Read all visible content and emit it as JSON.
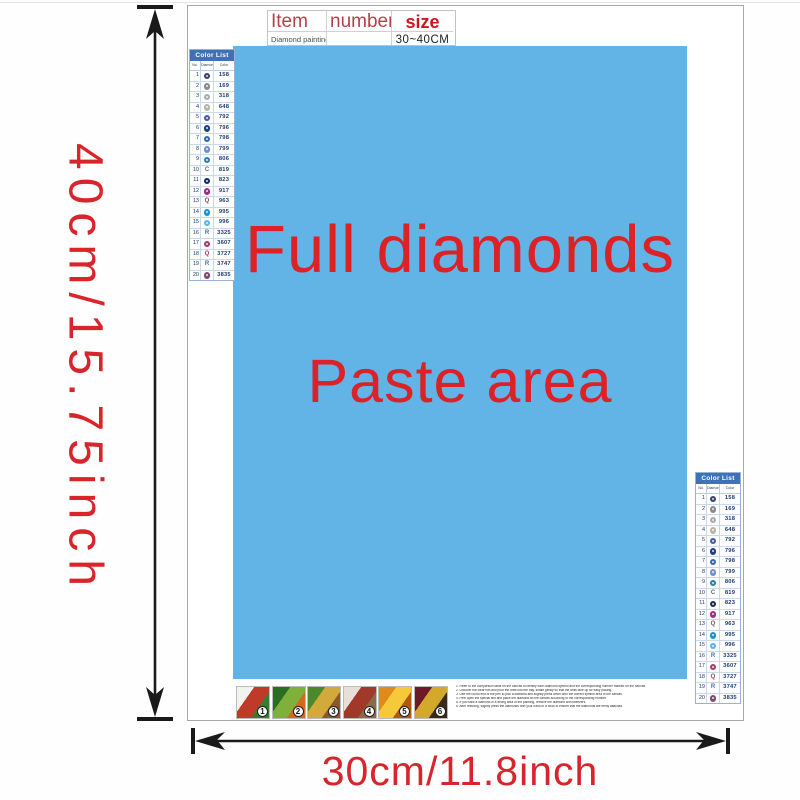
{
  "dimensions": {
    "height_label": "40cm/15.75inch",
    "width_label": "30cm/11.8inch",
    "arrow_color": "#1a1a1a",
    "label_color": "#d8242b"
  },
  "item_table": {
    "headers": [
      "Item",
      "number",
      "size"
    ],
    "row": {
      "item": "Diamond painting",
      "number": "",
      "size": "30~40CM"
    }
  },
  "canvas": {
    "bg": "#62b4e6",
    "line1": "Full diamonds",
    "line2": "Paste area",
    "text_color": "#dc2127"
  },
  "color_list": {
    "title": "Color List",
    "columns": [
      "No.",
      "Diamond",
      "Color"
    ],
    "header_bg": "#3e72b8",
    "rows": [
      {
        "no": "1",
        "type": "circle",
        "color": "#3a4272",
        "code": "158"
      },
      {
        "no": "2",
        "type": "circle",
        "color": "#8a8a90",
        "code": "169"
      },
      {
        "no": "3",
        "type": "circle",
        "color": "#a9a9ad",
        "code": "318"
      },
      {
        "no": "4",
        "type": "circle",
        "color": "#b9b4a8",
        "code": "648"
      },
      {
        "no": "5",
        "type": "circle",
        "color": "#4a5ba5",
        "code": "792"
      },
      {
        "no": "6",
        "type": "circle",
        "color": "#203d8e",
        "code": "796"
      },
      {
        "no": "7",
        "type": "circle",
        "color": "#3566b2",
        "code": "798"
      },
      {
        "no": "8",
        "type": "circle",
        "color": "#7090c8",
        "code": "799"
      },
      {
        "no": "9",
        "type": "circle",
        "color": "#2d7fb0",
        "code": "806"
      },
      {
        "no": "10",
        "type": "letter",
        "letter": "C",
        "color": "#5a6470",
        "code": "819"
      },
      {
        "no": "11",
        "type": "circle",
        "color": "#1c2b5e",
        "code": "823"
      },
      {
        "no": "12",
        "type": "circle",
        "color": "#9c2d8c",
        "code": "917"
      },
      {
        "no": "13",
        "type": "letter",
        "letter": "Q",
        "color": "#7c4a5a",
        "code": "963"
      },
      {
        "no": "14",
        "type": "circle",
        "color": "#1a93d0",
        "code": "995"
      },
      {
        "no": "15",
        "type": "circle",
        "color": "#55b8e8",
        "code": "996"
      },
      {
        "no": "16",
        "type": "letter",
        "letter": "R",
        "color": "#4a6ab0",
        "code": "3325"
      },
      {
        "no": "17",
        "type": "circle",
        "color": "#a33a6e",
        "code": "3607"
      },
      {
        "no": "18",
        "type": "letter",
        "letter": "Q",
        "color": "#a4385a",
        "code": "3727"
      },
      {
        "no": "19",
        "type": "letter",
        "letter": "R",
        "color": "#4a6ab0",
        "code": "3747"
      },
      {
        "no": "20",
        "type": "circle",
        "color": "#7e4a78",
        "code": "3835"
      }
    ]
  },
  "steps": {
    "items": [
      {
        "num": "1",
        "colors": [
          "#f2f2ee",
          "#c03a2a",
          "#3a7a35"
        ]
      },
      {
        "num": "2",
        "colors": [
          "#2a6e22",
          "#7fb03a",
          "#d2691e"
        ]
      },
      {
        "num": "3",
        "colors": [
          "#4a8a2a",
          "#d2a93a",
          "#8a5a2a"
        ]
      },
      {
        "num": "4",
        "colors": [
          "#e8e0d8",
          "#a0392a",
          "#8a6a4a"
        ]
      },
      {
        "num": "5",
        "colors": [
          "#e08a1a",
          "#f5c93a",
          "#b05a10"
        ]
      },
      {
        "num": "6",
        "colors": [
          "#6e1a26",
          "#d2a92a",
          "#3a2a1a"
        ]
      }
    ]
  },
  "instructions": {
    "lines": [
      "1. Refer to the comparison table on the canvas to identify each diamond symbol and the corresponding number marked on the canvas.",
      "2. Uncover the clear film and pour the drills into the tray, shake gently so that the drills face up for easy picking.",
      "3. Use the round end of the pen to pick a diamond and slightly press down onto the correct symbol area of the canvas.",
      "4. Peel open the special film and place the diamond on the canvas according to the corresponding number.",
      "5. If you stick a diamond in a wrong area of the painting, remove the diamond with tweezers.",
      "6. After finishing, slightly press the diamonds with your hand or a book to ensure that the diamonds are firmly attached."
    ]
  }
}
